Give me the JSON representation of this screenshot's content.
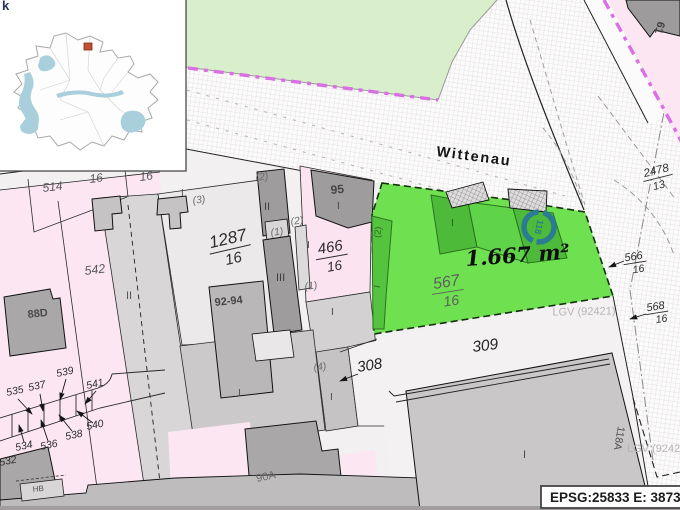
{
  "map": {
    "street_name": "Wittenau",
    "corner_fragment": "k",
    "watermark": "LGV (92421)",
    "highlight": {
      "area": "1.667 m²",
      "circle": "118",
      "parcel_num": "567",
      "parcel_den": "16",
      "floors": "I",
      "annex": "(2)"
    },
    "fractions": {
      "p1287": {
        "num": "1287",
        "den": "16"
      },
      "p466": {
        "num": "466",
        "den": "16"
      },
      "p2478": {
        "num": "2478",
        "den": "13"
      },
      "p566": {
        "num": "566",
        "den": "16"
      },
      "p568": {
        "num": "568",
        "den": "16"
      }
    },
    "parcel_ids": {
      "n514": "514",
      "n542": "542",
      "n16a": "16",
      "n16b": "16",
      "n308": "308",
      "n309": "309",
      "n532": "532",
      "n534": "534",
      "n535": "535",
      "n536": "536",
      "n537": "537",
      "n538": "538",
      "n539": "539",
      "n540": "540",
      "n541": "541"
    },
    "house_numbers": {
      "h88d": "88D",
      "h9294": "92-94",
      "h95": "95",
      "h61": "61",
      "h90a": "90A",
      "h118a": "118A",
      "hhb": "HB"
    },
    "floors": {
      "f2a": "(2)",
      "f2b": "(2)",
      "f1a": "(1)",
      "f1b": "(1)",
      "f3": "(3)",
      "f4": "(4)",
      "rII_a": "II",
      "rII_b": "II",
      "rIII": "III",
      "rI_a": "I",
      "rI_b": "I",
      "rI_c": "I",
      "rI_d": "I",
      "rI_e": "I",
      "rI_f": "I",
      "rI_g": "I"
    }
  },
  "statusbar": {
    "epsg_label": "EPSG:25833 E: 38737"
  },
  "colors": {
    "highlight_green": "#6fe151",
    "building_green": "#4eba39",
    "park_green": "#d9efcb",
    "parcel_pink": "#fbe6f1",
    "boundary_magenta": "#d96fe3",
    "circle_teal": "#2b7c93",
    "marker_red": "#c14f31"
  }
}
